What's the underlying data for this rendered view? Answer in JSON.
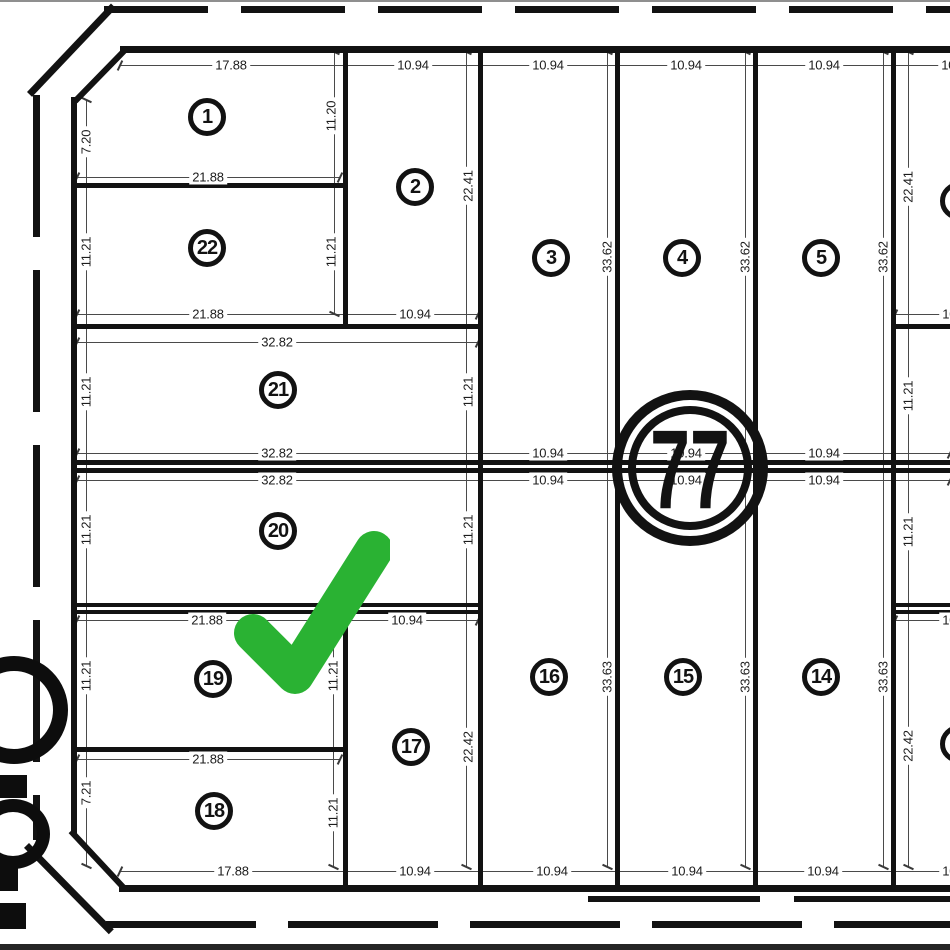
{
  "drawing": {
    "block_label": "77",
    "lots": [
      {
        "number": "1",
        "x": 207,
        "y": 117
      },
      {
        "number": "22",
        "x": 207,
        "y": 248
      },
      {
        "number": "2",
        "x": 415,
        "y": 187
      },
      {
        "number": "3",
        "x": 551,
        "y": 258
      },
      {
        "number": "4",
        "x": 682,
        "y": 258
      },
      {
        "number": "5",
        "x": 821,
        "y": 258
      },
      {
        "number": "21",
        "x": 278,
        "y": 390
      },
      {
        "number": "20",
        "x": 278,
        "y": 531
      },
      {
        "number": "19",
        "x": 213,
        "y": 679
      },
      {
        "number": "18",
        "x": 214,
        "y": 811
      },
      {
        "number": "17",
        "x": 411,
        "y": 747
      },
      {
        "number": "16",
        "x": 549,
        "y": 677
      },
      {
        "number": "15",
        "x": 683,
        "y": 677
      },
      {
        "number": "14",
        "x": 821,
        "y": 677
      }
    ],
    "dimensions": [
      {
        "text": "17.88",
        "x": 231,
        "y": 65
      },
      {
        "text": "10.94",
        "x": 413,
        "y": 65
      },
      {
        "text": "10.94",
        "x": 548,
        "y": 65
      },
      {
        "text": "10.94",
        "x": 686,
        "y": 65
      },
      {
        "text": "10.94",
        "x": 824,
        "y": 65
      },
      {
        "text": "10.94",
        "x": 957,
        "y": 65
      },
      {
        "text": "7.20",
        "x": 86,
        "y": 142,
        "orient": "v"
      },
      {
        "text": "11.20",
        "x": 331,
        "y": 116,
        "orient": "v"
      },
      {
        "text": "22.41",
        "x": 468,
        "y": 186,
        "orient": "v"
      },
      {
        "text": "33.62",
        "x": 607,
        "y": 257,
        "orient": "v"
      },
      {
        "text": "33.62",
        "x": 745,
        "y": 257,
        "orient": "v"
      },
      {
        "text": "33.62",
        "x": 883,
        "y": 257,
        "orient": "v"
      },
      {
        "text": "22.41",
        "x": 908,
        "y": 187,
        "orient": "v"
      },
      {
        "text": "21.88",
        "x": 208,
        "y": 177
      },
      {
        "text": "11.21",
        "x": 86,
        "y": 252,
        "orient": "v"
      },
      {
        "text": "11.21",
        "x": 331,
        "y": 252,
        "orient": "v"
      },
      {
        "text": "21.88",
        "x": 208,
        "y": 314
      },
      {
        "text": "10.94",
        "x": 415,
        "y": 314
      },
      {
        "text": "10.94",
        "x": 958,
        "y": 314
      },
      {
        "text": "32.82",
        "x": 277,
        "y": 342
      },
      {
        "text": "11.21",
        "x": 86,
        "y": 392,
        "orient": "v"
      },
      {
        "text": "11.21",
        "x": 468,
        "y": 392,
        "orient": "v"
      },
      {
        "text": "11.21",
        "x": 908,
        "y": 396,
        "orient": "v"
      },
      {
        "text": "32.82",
        "x": 277,
        "y": 453
      },
      {
        "text": "10.94",
        "x": 548,
        "y": 453
      },
      {
        "text": "10.94",
        "x": 686,
        "y": 453
      },
      {
        "text": "10.94",
        "x": 824,
        "y": 453
      },
      {
        "text": "32.82",
        "x": 277,
        "y": 480
      },
      {
        "text": "10.94",
        "x": 548,
        "y": 480
      },
      {
        "text": "10.94",
        "x": 686,
        "y": 480
      },
      {
        "text": "10.94",
        "x": 824,
        "y": 480
      },
      {
        "text": "11.21",
        "x": 86,
        "y": 530,
        "orient": "v"
      },
      {
        "text": "11.21",
        "x": 468,
        "y": 530,
        "orient": "v"
      },
      {
        "text": "11.21",
        "x": 908,
        "y": 532,
        "orient": "v"
      },
      {
        "text": "21.88",
        "x": 207,
        "y": 620
      },
      {
        "text": "10.94",
        "x": 407,
        "y": 620
      },
      {
        "text": "10.94",
        "x": 958,
        "y": 620
      },
      {
        "text": "11.21",
        "x": 86,
        "y": 676,
        "orient": "v"
      },
      {
        "text": "11.21",
        "x": 333,
        "y": 676,
        "orient": "v"
      },
      {
        "text": "33.63",
        "x": 607,
        "y": 677,
        "orient": "v"
      },
      {
        "text": "33.63",
        "x": 745,
        "y": 677,
        "orient": "v"
      },
      {
        "text": "33.63",
        "x": 883,
        "y": 677,
        "orient": "v"
      },
      {
        "text": "22.42",
        "x": 468,
        "y": 747,
        "orient": "v"
      },
      {
        "text": "22.42",
        "x": 908,
        "y": 746,
        "orient": "v"
      },
      {
        "text": "21.88",
        "x": 208,
        "y": 759
      },
      {
        "text": "7.21",
        "x": 86,
        "y": 793,
        "orient": "v"
      },
      {
        "text": "11.21",
        "x": 333,
        "y": 813,
        "orient": "v"
      },
      {
        "text": "17.88",
        "x": 233,
        "y": 871
      },
      {
        "text": "10.94",
        "x": 415,
        "y": 871
      },
      {
        "text": "10.94",
        "x": 552,
        "y": 871
      },
      {
        "text": "10.94",
        "x": 687,
        "y": 871
      },
      {
        "text": "10.94",
        "x": 823,
        "y": 871
      },
      {
        "text": "10.94",
        "x": 958,
        "y": 871
      }
    ],
    "annotation": {
      "type": "checkmark",
      "color": "#2ab233"
    }
  }
}
